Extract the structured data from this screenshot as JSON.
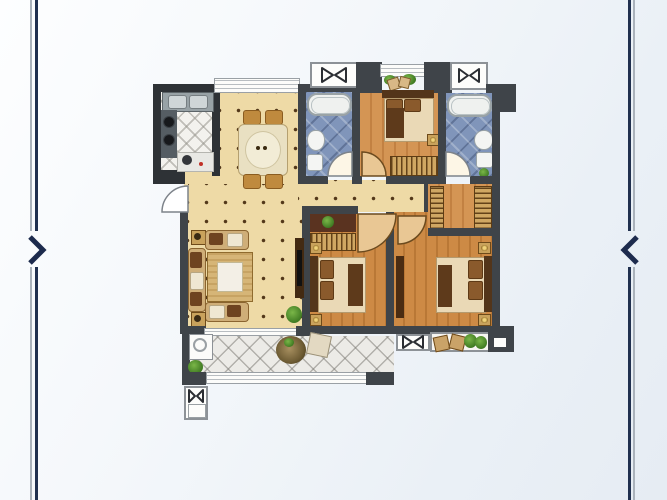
{
  "viewer": {
    "type": "floor-plan gallery slide",
    "prev_arrow_glyph": ">",
    "next_arrow_glyph": "<",
    "accent_color": "#20304f",
    "frame_line_light": "#aab2bb",
    "background_top": "#fdfeff",
    "background_bottom": "#e6ecf3"
  },
  "palette": {
    "wall": "#3f4449",
    "wall_dark": "#2e3236",
    "tile_beige": "#eedaa6",
    "tile_blue": "#8095ba",
    "tile_white": "#f3f2ee",
    "tile_balcony": "#ecebe7",
    "wood_light": "#d49554",
    "wood_dark": "#cd8a45",
    "wardrobe": "#cfa763",
    "bedding": "#ead9b6",
    "headboard": "#53351a",
    "plant_green": "#3f7a22",
    "fixture_white": "#fdfdfb"
  },
  "floor_plan": {
    "rooms": [
      {
        "id": "kitchen",
        "name": "Kitchen"
      },
      {
        "id": "dining",
        "name": "Dining room"
      },
      {
        "id": "bath-north",
        "name": "Bathroom"
      },
      {
        "id": "bedroom-north",
        "name": "Bedroom"
      },
      {
        "id": "bath-east",
        "name": "Bathroom"
      },
      {
        "id": "hallway",
        "name": "Hallway"
      },
      {
        "id": "cloakroom",
        "name": "Cloakroom"
      },
      {
        "id": "living",
        "name": "Living room"
      },
      {
        "id": "bedroom-master",
        "name": "Master bedroom"
      },
      {
        "id": "bedroom-south",
        "name": "Bedroom"
      },
      {
        "id": "balcony",
        "name": "Balcony"
      },
      {
        "id": "ac-platform",
        "name": "A/C platform"
      }
    ],
    "fixtures": [
      "sink-unit",
      "gas-stove",
      "dining-table",
      "bathtub",
      "toilet",
      "washbasin",
      "double-bed",
      "wardrobe",
      "nightstand-lamp",
      "sofa-set",
      "coffee-table",
      "tv-cabinet",
      "washing-machine",
      "potted-plant",
      "balcony-railing",
      "ac-unit-symbol",
      "door-swing",
      "window"
    ]
  }
}
